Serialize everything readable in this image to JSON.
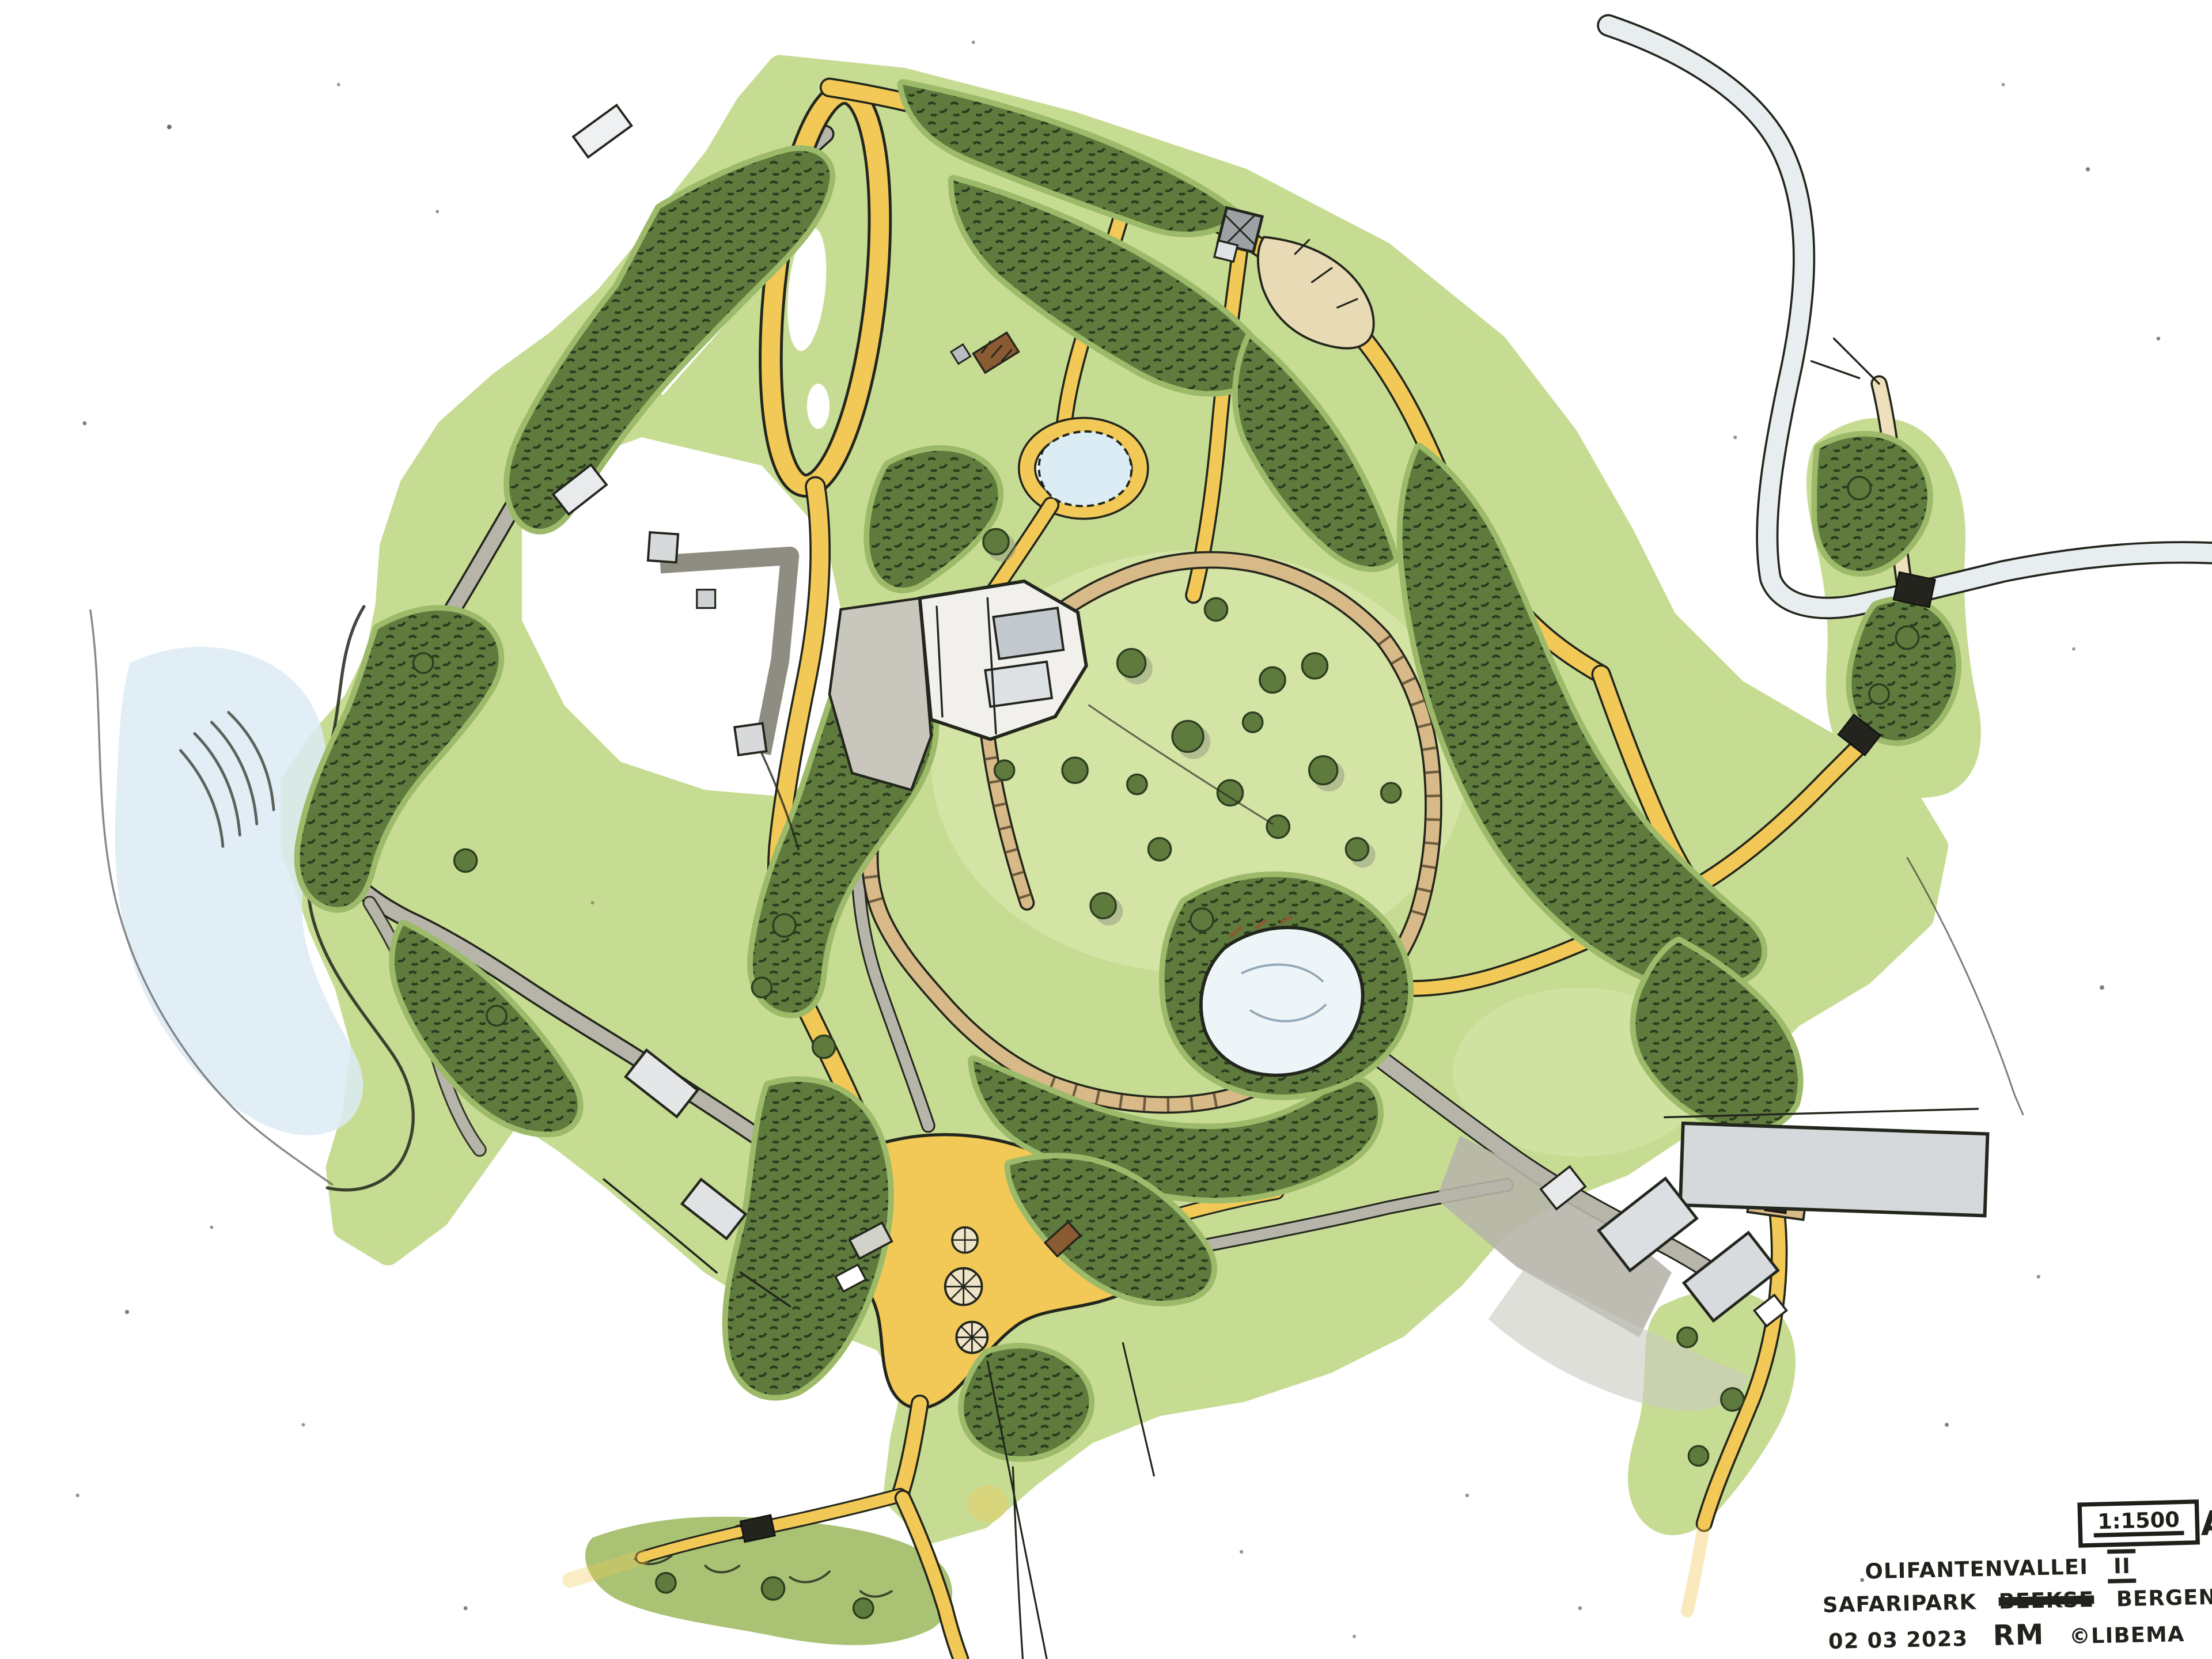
{
  "title_block": {
    "scale": "1:1500",
    "sheet_letter": "A",
    "project_name": "OLIFANTENVALLEI",
    "phase_numeral": "II",
    "location": {
      "word1": "SAFARIPARK",
      "struck_word": "BEEKSE",
      "word2": "BERGEN"
    },
    "date": "02 03 2023",
    "author_initials": "RM",
    "copyright": "©LIBEMA"
  },
  "map": {
    "type": "hand-drawn landscape site plan, marker and ink on white paper",
    "feature_icons": [
      "lake-icon",
      "central-pond-icon",
      "small-pond-icon",
      "main-lawn-icon",
      "forest-cluster-icon",
      "yellow-visitor-path-icon",
      "cream-path-icon",
      "boardwalk-icon",
      "service-road-icon",
      "perimeter-road-icon",
      "bridge-icon",
      "main-building-icon",
      "barn-complex-icon",
      "lookout-building-icon",
      "entrance-plaza-icon",
      "parasol-icon",
      "shed-icon",
      "fence-icon"
    ],
    "colors": {
      "paper": "#ffffff",
      "grass": "#c7dc93",
      "grass_light": "#d8e7ab",
      "grass_halo": "#9cba6a",
      "forest": "#5f7a3d",
      "forest_dark": "#2c3e20",
      "path_yellow": "#f2c957",
      "path_cream": "#eee0ba",
      "boardwalk_tan": "#d8b988",
      "road_gray": "#b7b5aa",
      "road_pale": "#e8edf0",
      "water": "#dcebf3",
      "building_gray": "#d6d9db",
      "ink": "#23261c",
      "wood_brown": "#8a5a33"
    }
  }
}
